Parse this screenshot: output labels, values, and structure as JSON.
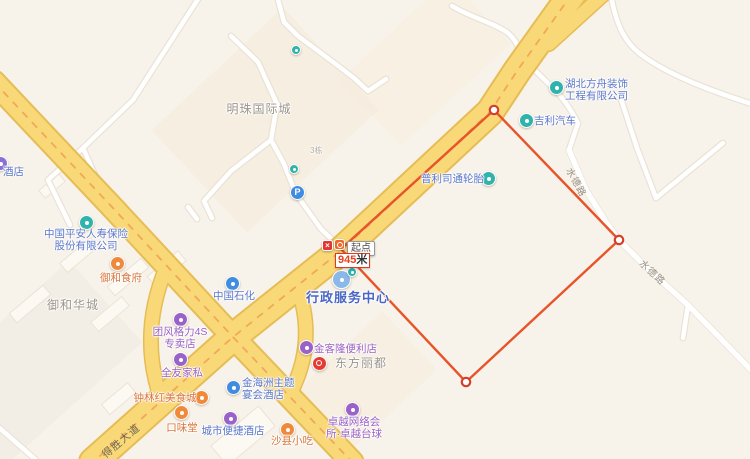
{
  "app": "map-view",
  "colors": {
    "land": "#f8f3ea",
    "major_road_fill": "#f9d877",
    "major_road_casing": "#e6bc55",
    "road_center_dash": "#f0a055",
    "minor_road_fill": "#ffffff",
    "measure_line": "#e8542a",
    "poi_blue": "#5a77c9",
    "poi_purple": "#9a62c3",
    "poi_food_orange": "#d8753c",
    "poi_gray": "#9c948a",
    "gov_blue": "#4a66c4"
  },
  "measure": {
    "start_label": "起点",
    "distance_value": "945",
    "distance_unit": "米"
  },
  "road_labels": {
    "desheng": "得胜大道",
    "shuide_upper": "水德路",
    "shuide_lower": "水德路"
  },
  "misc": {
    "parking_letter": "P",
    "red_poi_glyph": "×",
    "building_no": "3栋"
  },
  "pois": {
    "hotel_partial": {
      "text": "酒店"
    },
    "pingan": {
      "lines": [
        "中国平安人寿保险",
        "股份有限公司"
      ]
    },
    "yuhe_shifu": {
      "text": "御和食府"
    },
    "yuhe_huacheng": {
      "text": "御和华城"
    },
    "zhongguo_shihua": {
      "text": "中国石化"
    },
    "geli": {
      "lines": [
        "团风格力4S",
        "专卖店"
      ]
    },
    "quanyou": {
      "text": "全友家私"
    },
    "mingzhu": {
      "text": "明珠国际城"
    },
    "puli": {
      "text": "普利司通轮胎"
    },
    "jili": {
      "text": "吉利汽车"
    },
    "fangzhou": {
      "lines": [
        "湖北方舟装饰",
        "工程有限公司"
      ]
    },
    "xingzheng": {
      "text": "行政服务中心"
    },
    "jinkelong": {
      "text": "金客隆便利店"
    },
    "dongfang": {
      "text": "东方丽都"
    },
    "jinhaizhou": {
      "lines": [
        "金海洲主题",
        "宴会酒店"
      ]
    },
    "zhonglinhong": {
      "text": "钟林红美食城"
    },
    "kouweitang": {
      "text": "口味堂"
    },
    "chengshi": {
      "text": "城市便捷酒店"
    },
    "shaxian": {
      "text": "沙县小吃"
    },
    "zhuoyue": {
      "lines": [
        "卓越网络会",
        "所·卓越台球"
      ]
    }
  }
}
